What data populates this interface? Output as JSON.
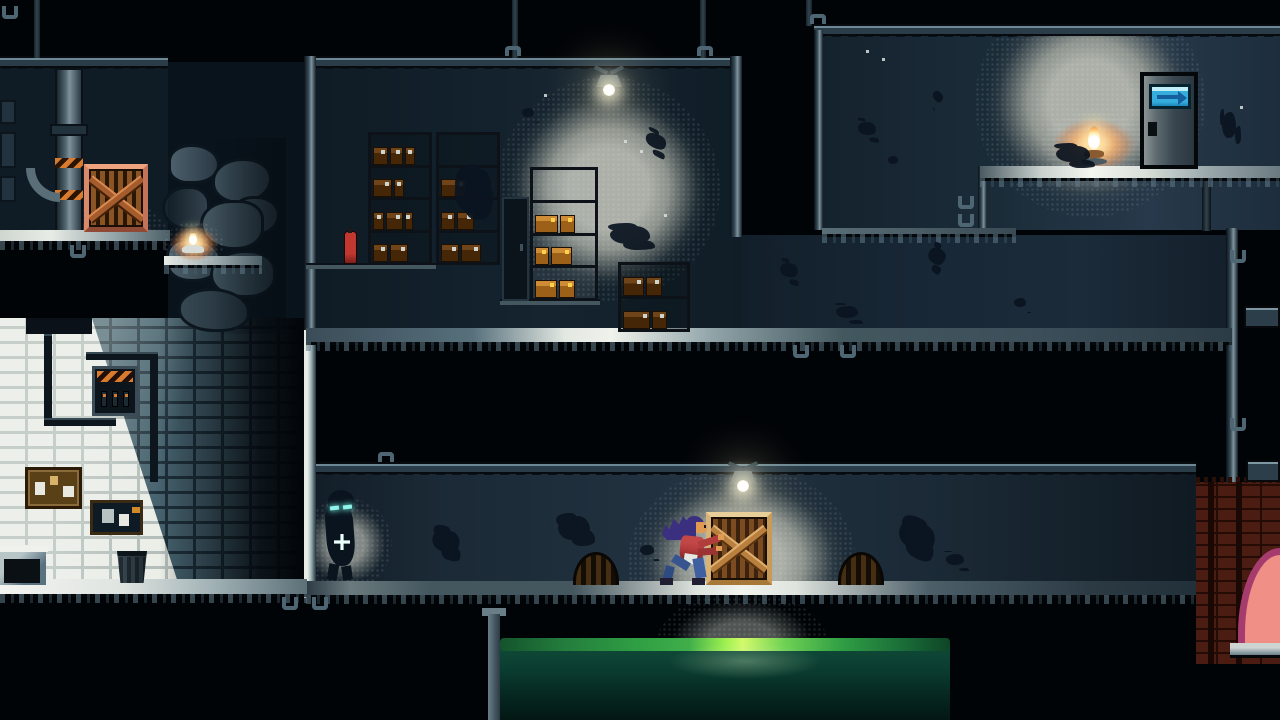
{
  "palette": {
    "void": "#010407",
    "room_dark": "#101d28",
    "room_storage": "#12202b",
    "room_corridor": "#1a2935",
    "room_topright": "#1b2c39",
    "beam": "#2a3c48",
    "beam_edge": "#6d8894",
    "floor_lit": "#f0f2ec",
    "floor_dim": "#3a4c58",
    "light_gray": "#999b94",
    "light_warm": "#ffc878",
    "flame": "#fff6d8",
    "crate_frame": "#d8ab69",
    "crate_slat": "#7c4c20",
    "crate_warm_frame": "#d98a6a",
    "box_dark": "#6e4418",
    "box_lit": "#cf8c36",
    "enemy_glow": "#8ff4ec",
    "player_hair": "#3b2f80",
    "player_skin": "#e09a52",
    "player_shirt": "#b03a3a",
    "player_pants": "#3f5fa0",
    "door_sign": "#35aedd",
    "door_sign_arrow": "#145f9c",
    "water_bright": "#b6f55a",
    "water_green": "#2f9e44",
    "water_deep": "#0a3a2e",
    "brick_white": "#eceee8",
    "brick_shadow": "#46626e",
    "hazard": "#d97b2f",
    "arch_pink": "#ef8f85",
    "arch_rim": "#a63c6e",
    "brick_red": "#4a1c12"
  },
  "scene": {
    "objects": {
      "glow_crate_warm": {
        "name": "warm-light-glow",
        "x": 52,
        "y": 136,
        "w": 124,
        "h": 124
      },
      "glow_candle": {
        "name": "candle-glow",
        "x": 164,
        "y": 222,
        "w": 60,
        "h": 44
      },
      "glow_storage": {
        "name": "storage-lamp-glow",
        "x": 190,
        "y": 15,
        "w": 224,
        "h": 224
      },
      "glow_topright": {
        "name": "topright-lamp-glow",
        "x": 161,
        "y": -43,
        "w": 230,
        "h": 230
      },
      "glow_oillamp": {
        "name": "oil-lamp-warm-glow",
        "x": 228,
        "y": 82,
        "w": 104,
        "h": 66
      },
      "glow_corridor": {
        "name": "corridor-lamp-glow",
        "x": 322,
        "y": -2,
        "w": 228,
        "h": 192
      },
      "glow_enemy": {
        "name": "enemy-spotlight-glow",
        "x": -6,
        "y": 30,
        "w": 92,
        "h": 92
      },
      "glow_water": {
        "name": "underfloor-glow",
        "x": 657,
        "y": 592,
        "w": 170,
        "h": 100
      },
      "rocks": {
        "name": "cave-rock-pile",
        "x": 162,
        "y": 138,
        "w": 124,
        "h": 196
      },
      "crate_warm": {
        "name": "wooden-crate-warm-lit",
        "x": 84,
        "y": 164,
        "w": 64,
        "h": 68
      },
      "candle": {
        "name": "candle-on-ledge",
        "x": 180,
        "y": 232,
        "w": 26,
        "h": 24
      },
      "storage_lamp": {
        "name": "ceiling-lamp-storage",
        "x": 590,
        "y": 66,
        "w": 38,
        "h": 32
      },
      "corridor_lamp": {
        "name": "ceiling-lamp-corridor",
        "x": 724,
        "y": 462,
        "w": 38,
        "h": 32
      },
      "shelf_a": {
        "name": "storage-shelf-left",
        "x": 368,
        "y": 132,
        "w": 64,
        "h": 133,
        "rows": [
          [
            28,
            24,
            18
          ],
          [
            36,
            18
          ],
          [
            20,
            32,
            14
          ],
          [
            28,
            34
          ]
        ]
      },
      "shelf_b": {
        "name": "storage-shelf-mid",
        "x": 436,
        "y": 132,
        "w": 64,
        "h": 133,
        "rows": [
          [],
          [
            46
          ],
          [
            26,
            32
          ],
          [
            34,
            36
          ]
        ]
      },
      "locker": {
        "name": "metal-locker",
        "x": 502,
        "y": 197,
        "w": 27,
        "h": 104
      },
      "shelf_lit": {
        "name": "storage-shelf-lit",
        "x": 530,
        "y": 167,
        "w": 68,
        "h": 134,
        "rows": [
          [],
          [
            40,
            26
          ],
          [
            24,
            36
          ],
          [
            38,
            28
          ]
        ]
      },
      "shelf_small": {
        "name": "storage-shelf-small",
        "x": 618,
        "y": 262,
        "w": 72,
        "h": 70,
        "rows": [
          [
            34,
            26
          ],
          [
            44,
            24
          ]
        ]
      },
      "extinguisher": {
        "name": "fire-extinguisher",
        "x": 344,
        "y": 231,
        "w": 13,
        "h": 33
      },
      "fuse_box": {
        "name": "fuse-box",
        "x": 92,
        "y": 366,
        "w": 46,
        "h": 50
      },
      "cork_board": {
        "name": "cork-board",
        "x": 25,
        "y": 467,
        "w": 57,
        "h": 42
      },
      "notice_board": {
        "name": "notice-board",
        "x": 90,
        "y": 500,
        "w": 53,
        "h": 35
      },
      "trash_can": {
        "name": "trash-can",
        "x": 115,
        "y": 551,
        "w": 34,
        "h": 32
      },
      "door": {
        "name": "exit-door",
        "x": 1140,
        "y": 72,
        "w": 58,
        "h": 97
      },
      "oil_lamp": {
        "name": "oil-lamp",
        "x": 1080,
        "y": 126,
        "w": 28,
        "h": 44
      },
      "drain_left": {
        "name": "drain-arch-left",
        "x": 573,
        "y": 552,
        "w": 46,
        "h": 33
      },
      "drain_right": {
        "name": "drain-arch-right",
        "x": 838,
        "y": 552,
        "w": 46,
        "h": 33
      },
      "water": {
        "name": "toxic-water-pool",
        "x": 500,
        "y": 638,
        "w": 450,
        "h": 82
      },
      "brick_red_area": {
        "name": "red-brick-corner",
        "x": 1196,
        "y": 482,
        "w": 84,
        "h": 182
      },
      "arch": {
        "name": "pink-arch-opening",
        "x": 1238,
        "y": 548,
        "w": 42,
        "h": 100
      },
      "crate_push": {
        "name": "wooden-crate-pushed",
        "x": 706,
        "y": 512,
        "w": 66,
        "h": 73
      },
      "player": {
        "name": "player-character",
        "x": 660,
        "y": 512,
        "w": 64,
        "h": 73
      },
      "enemy": {
        "name": "shadow-enemy",
        "x": 320,
        "y": 490,
        "w": 46,
        "h": 95
      }
    },
    "splatters": [
      {
        "x": 455,
        "y": 168,
        "w": 36,
        "h": 44,
        "r": 15
      },
      {
        "x": 610,
        "y": 226,
        "w": 40,
        "h": 18,
        "r": 0
      },
      {
        "x": 645,
        "y": 134,
        "w": 22,
        "h": 14,
        "r": 30
      },
      {
        "x": 522,
        "y": 108,
        "w": 12,
        "h": 9,
        "r": 0
      },
      {
        "x": 780,
        "y": 263,
        "w": 18,
        "h": 14,
        "r": 20
      },
      {
        "x": 836,
        "y": 306,
        "w": 22,
        "h": 12,
        "r": 0
      },
      {
        "x": 928,
        "y": 248,
        "w": 18,
        "h": 16,
        "r": 45
      },
      {
        "x": 1014,
        "y": 298,
        "w": 12,
        "h": 9,
        "r": 0
      },
      {
        "x": 858,
        "y": 122,
        "w": 18,
        "h": 13,
        "r": 10
      },
      {
        "x": 888,
        "y": 156,
        "w": 10,
        "h": 8,
        "r": 0
      },
      {
        "x": 1056,
        "y": 146,
        "w": 34,
        "h": 16,
        "r": 0
      },
      {
        "x": 932,
        "y": 92,
        "w": 12,
        "h": 9,
        "r": 60
      },
      {
        "x": 1222,
        "y": 112,
        "w": 14,
        "h": 26,
        "r": 0
      },
      {
        "x": 432,
        "y": 530,
        "w": 28,
        "h": 22,
        "r": 20
      },
      {
        "x": 558,
        "y": 516,
        "w": 32,
        "h": 24,
        "r": 0
      },
      {
        "x": 640,
        "y": 545,
        "w": 14,
        "h": 10,
        "r": 0
      },
      {
        "x": 898,
        "y": 522,
        "w": 38,
        "h": 28,
        "r": 30
      },
      {
        "x": 946,
        "y": 554,
        "w": 18,
        "h": 11,
        "r": 0
      }
    ],
    "dust": [
      {
        "x": 624,
        "y": 140
      },
      {
        "x": 640,
        "y": 150
      },
      {
        "x": 544,
        "y": 94
      },
      {
        "x": 866,
        "y": 50
      },
      {
        "x": 882,
        "y": 58
      },
      {
        "x": 1240,
        "y": 106
      },
      {
        "x": 664,
        "y": 214
      }
    ],
    "clamps": [
      {
        "x": 505,
        "y": 46,
        "t": "t"
      },
      {
        "x": 697,
        "y": 46,
        "t": "t"
      },
      {
        "x": 810,
        "y": 14,
        "t": "t"
      },
      {
        "x": 378,
        "y": 452,
        "t": "t"
      },
      {
        "x": 70,
        "y": 245,
        "t": "d"
      },
      {
        "x": 2,
        "y": 6,
        "t": "d"
      },
      {
        "x": 282,
        "y": 597,
        "t": "d"
      },
      {
        "x": 312,
        "y": 597,
        "t": "d"
      },
      {
        "x": 793,
        "y": 345,
        "t": "d"
      },
      {
        "x": 840,
        "y": 345,
        "t": "d"
      },
      {
        "x": 1230,
        "y": 250,
        "t": "d"
      },
      {
        "x": 1230,
        "y": 418,
        "t": "d"
      },
      {
        "x": 958,
        "y": 196,
        "t": "d"
      },
      {
        "x": 958,
        "y": 214,
        "t": "d"
      }
    ]
  }
}
